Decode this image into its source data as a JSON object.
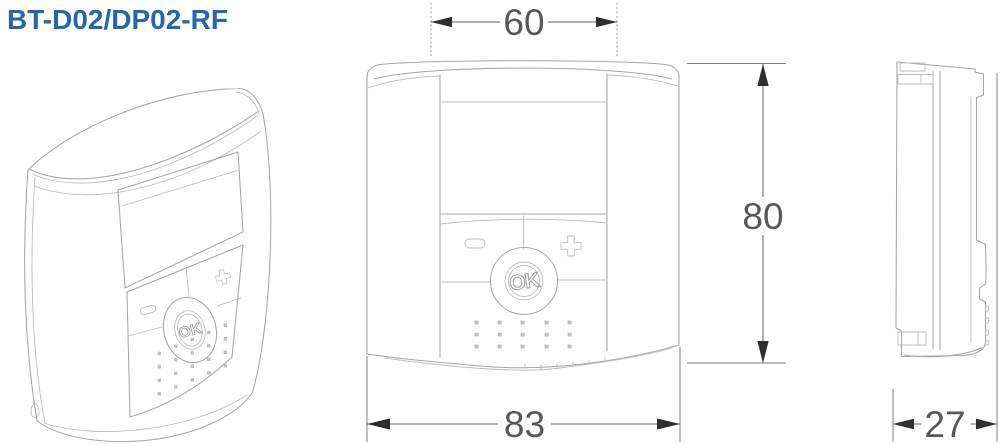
{
  "title": "BT-D02/DP02-RF",
  "views": {
    "perspective": {
      "ok_label": "OK"
    },
    "front": {
      "ok_label": "OK"
    },
    "side": {}
  },
  "dimensions": {
    "display_width": {
      "value": "60"
    },
    "body_width": {
      "value": "83"
    },
    "body_height": {
      "value": "80"
    },
    "body_depth": {
      "value": "27"
    }
  },
  "colors": {
    "title_blue": "#2766a7",
    "drawing_line": "#a6a6a6",
    "dimension_line": "#606060",
    "dimension_text": "#585858",
    "background": "#ffffff"
  }
}
